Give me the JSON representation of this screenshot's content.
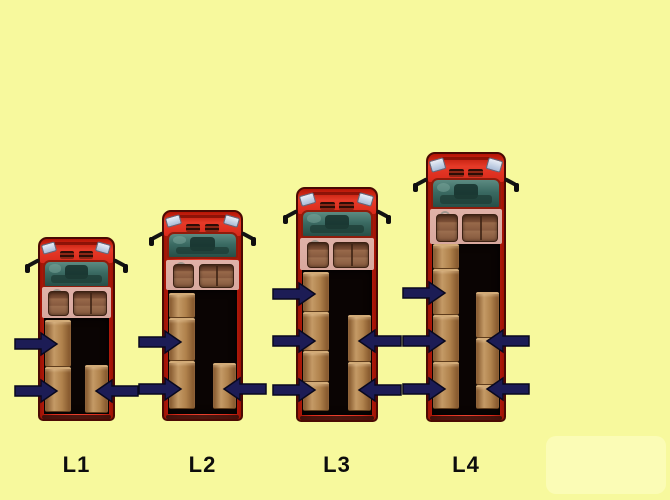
{
  "scene": {
    "width": 670,
    "height": 500,
    "background_color": "#f7f99d",
    "corner_panel": {
      "x": 546,
      "y": 436,
      "width": 120,
      "height": 58,
      "color": "#fbfcb6"
    }
  },
  "colors": {
    "truck_red": "#d9291a",
    "truck_red_bright": "#e8402e",
    "truck_red_dark": "#9d1204",
    "truck_outline": "#4a0a03",
    "hood_top": "#b51505",
    "headlight": "#e9eef6",
    "grille_dark": "#2d0d06",
    "windshield_top": "#5c8a81",
    "windshield_bottom": "#284e47",
    "dashboard_dark": "#15302b",
    "cab_interior": "#d8a89e",
    "seat_brown": "#875a3f",
    "seat_dark": "#3c2213",
    "cargo_black": "#0a0403",
    "box_light": "#c49a66",
    "box_mid": "#b0824c",
    "box_dark": "#7e5128",
    "box_seam": "#d2ab78",
    "arrow_navy": "#1c1c55",
    "arrow_outline": "#08081e",
    "mirror_black": "#141414",
    "label_color": "#0d0d0d"
  },
  "labels_y": 452,
  "arrow_geometry": {
    "length": 42,
    "head_len": 16,
    "shaft_half": 5,
    "head_half": 11,
    "tip_inset": 19
  },
  "trucks": [
    {
      "label": "L1",
      "left": 38,
      "top": 237,
      "width": 77,
      "height": 184,
      "cab_height": 81,
      "boxes_left": [
        [
          320,
          47
        ],
        [
          367,
          45
        ]
      ],
      "boxes_right": [
        [
          365,
          48
        ]
      ],
      "arrows_left_y": [
        344,
        391
      ],
      "arrows_right_y": [
        391
      ]
    },
    {
      "label": "L2",
      "left": 162,
      "top": 210,
      "width": 81,
      "height": 211,
      "cab_height": 80,
      "boxes_left": [
        [
          293,
          25
        ],
        [
          318,
          43
        ],
        [
          361,
          48
        ]
      ],
      "boxes_right": [
        [
          363,
          46
        ]
      ],
      "arrows_left_y": [
        342,
        389
      ],
      "arrows_right_y": [
        389
      ]
    },
    {
      "label": "L3",
      "left": 296,
      "top": 187,
      "width": 82,
      "height": 235,
      "cab_height": 83,
      "boxes_left": [
        [
          272,
          40
        ],
        [
          312,
          39
        ],
        [
          351,
          31
        ],
        [
          382,
          29
        ]
      ],
      "boxes_right": [
        [
          315,
          47
        ],
        [
          362,
          49
        ]
      ],
      "arrows_left_y": [
        294,
        341,
        390
      ],
      "arrows_right_y": [
        341,
        390
      ]
    },
    {
      "label": "L4",
      "left": 426,
      "top": 152,
      "width": 80,
      "height": 270,
      "cab_height": 92,
      "boxes_left": [
        [
          244,
          25
        ],
        [
          269,
          46
        ],
        [
          315,
          47
        ],
        [
          362,
          47
        ]
      ],
      "boxes_right": [
        [
          292,
          46
        ],
        [
          338,
          47
        ],
        [
          385,
          24
        ]
      ],
      "arrows_left_y": [
        293,
        341,
        389
      ],
      "arrows_right_y": [
        341,
        389
      ]
    }
  ]
}
